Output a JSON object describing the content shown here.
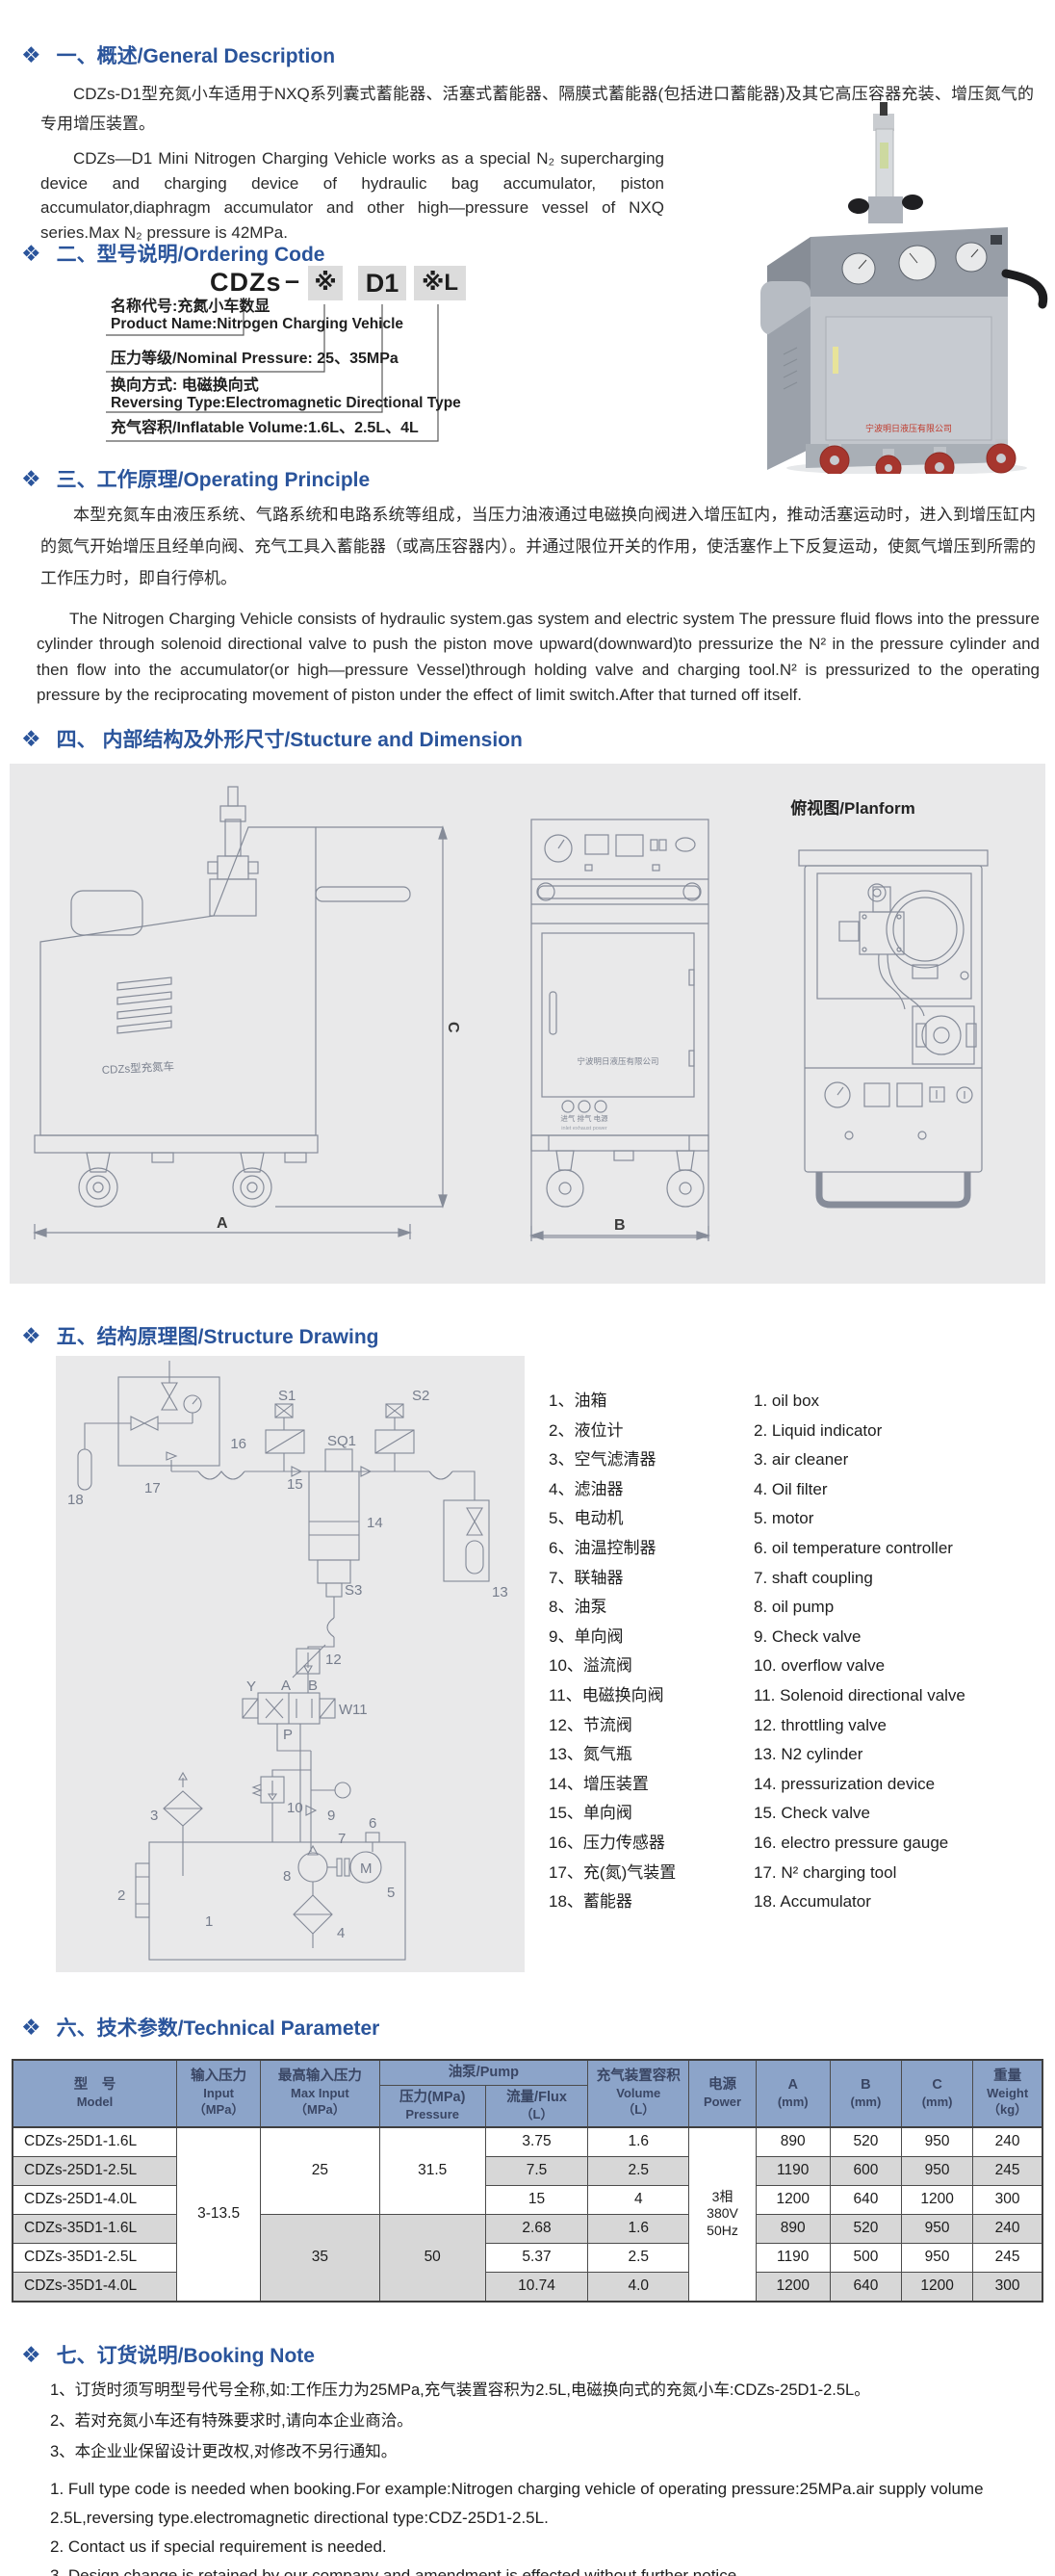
{
  "bullet": "❖",
  "s1": {
    "title": "一、概述/General Description",
    "para_cn": "CDZs-D1型充氮小车适用于NXQ系列囊式蓄能器、活塞式蓄能器、隔膜式蓄能器(包括进口蓄能器)及其它高压容器充装、增压氮气的专用增压装置。",
    "para_en": "CDZs—D1 Mini Nitrogen Charging Vehicle works as a special N₂ supercharging device and charging device of hydraulic bag accumulator, piston accumulator,diaphragm accumulator and other high—pressure vessel of NXQ series.Max N₂ pressure is 42MPa."
  },
  "photo": {
    "company_text": "宁波明日液压有限公司"
  },
  "s2": {
    "title": "二、型号说明/Ordering Code",
    "code": {
      "prefix": "CDZs",
      "dash": "–",
      "star": "※",
      "mid": "D1",
      "suffix": "※L"
    },
    "labels": {
      "l1_cn": "名称代号:充氮小车数显",
      "l1_en": "Product Name:Nitrogen Charging Vehicle",
      "l2": "压力等级/Nominal Pressure: 25、35MPa",
      "l3_cn": "换向方式: 电磁换向式",
      "l3_en": "Reversing Type:Electromagnetic Directional Type",
      "l4": "充气容积/Inflatable Volume:1.6L、2.5L、4L"
    }
  },
  "s3": {
    "title": "三、工作原理/Operating Principle",
    "para_cn": "本型充氮车由液压系统、气路系统和电路系统等组成，当压力油液通过电磁换向阀进入增压缸内，推动活塞运动时，进入到增压缸内的氮气开始增压且经单向阀、充气工具入蓄能器（或高压容器内）。并通过限位开关的作用，使活塞作上下反复运动，使氮气增压到所需的工作压力时，即自行停机。",
    "para_en": "The Nitrogen Charging Vehicle consists of hydraulic system.gas system and electric system The pressure fluid flows into the pressure cylinder through solenoid directional valve to push the piston move upward(downward)to pressurize the N² in the pressure cylinder and then flow into the accumulator(or high—pressure Vessel)through holding valve and charging tool.N² is pressurized to the operating pressure by the reciprocating movement of piston under the effect of limit switch.After that turned off itself."
  },
  "s4": {
    "title": "四、 内部结构及外形尺寸/Stucture and Dimension",
    "planform_label": "俯视图/Planform",
    "dim_a": "A",
    "dim_b": "B",
    "dim_c": "C",
    "side_label": "CDZs型充氮车",
    "front_company": "宁波明日液压有限公司",
    "port_labels": "进气  排气  电源",
    "port_labels_en": "inlet exhaust power"
  },
  "s5": {
    "title": "五、结构原理图/Structure Drawing",
    "parts_cn": [
      "1、油箱",
      "2、液位计",
      "3、空气滤清器",
      "4、滤油器",
      "5、电动机",
      "6、油温控制器",
      "7、联轴器",
      "8、油泵",
      "9、单向阀",
      "10、溢流阀",
      "11、电磁换向阀",
      "12、节流阀",
      "13、氮气瓶",
      "14、增压装置",
      "15、单向阀",
      "16、压力传感器",
      "17、充(氮)气装置",
      "18、蓄能器"
    ],
    "parts_en": [
      "1.  oil box",
      "2.  Liquid indicator",
      "3.  air cleaner",
      "4.  Oil filter",
      "5.  motor",
      "6.  oil temperature controller",
      "7.  shaft coupling",
      "8.  oil pump",
      "9.  Check valve",
      "10.  overflow valve",
      "11.  Solenoid directional valve",
      "12.  throttling valve",
      "13.  N2 cylinder",
      "14.  pressurization device",
      "15.  Check valve",
      "16.  electro pressure gauge",
      "17.  N² charging tool",
      "18.  Accumulator"
    ],
    "sch": {
      "s1": "S1",
      "s2": "S2",
      "sq1": "SQ1",
      "n16": "16",
      "n15": "15",
      "n17": "17",
      "n18": "18",
      "n14": "14",
      "s3": "S3",
      "n13": "13",
      "n12": "12",
      "n11": "11",
      "n10": "10",
      "n9": "9",
      "n8": "8",
      "n7": "7",
      "n6": "6",
      "n5": "5",
      "n4": "4",
      "n3": "3",
      "n2": "2",
      "n1": "1",
      "m": "M",
      "p": "P",
      "a": "A",
      "b": "B",
      "y": "Y",
      "w": "W"
    }
  },
  "s6": {
    "title": "六、技术参数/Technical Parameter",
    "header": {
      "model_cn": "型　号",
      "model_en": "Model",
      "input_cn": "输入压力",
      "input_en": "Input",
      "input_unit": "（MPa）",
      "max_cn": "最高输入压力",
      "max_en": "Max Input",
      "max_unit": "（MPa）",
      "pump": "油泵/Pump",
      "pressure_cn": "压力(MPa)",
      "pressure_en": "Pressure",
      "flux_cn": "流量/Flux",
      "flux_unit": "（L）",
      "volume_cn": "充气装置容积",
      "volume_en": "Volume",
      "volume_unit": "（L）",
      "power_cn": "电源",
      "power_en": "Power",
      "a": "A",
      "b": "B",
      "c": "C",
      "mm": "(mm)",
      "weight_cn": "重量",
      "weight_en": "Weight",
      "weight_unit": "（kg）"
    },
    "merged": {
      "input": "3-13.5",
      "max25": "25",
      "pressure25": "31.5",
      "max35": "35",
      "pressure35": "50",
      "power": "3相\n380V\n50Hz"
    },
    "rows": [
      {
        "model": "CDZs-25D1-1.6L",
        "flux": "3.75",
        "volume": "1.6",
        "a": "890",
        "b": "520",
        "c": "950",
        "weight": "240"
      },
      {
        "model": "CDZs-25D1-2.5L",
        "flux": "7.5",
        "volume": "2.5",
        "a": "1190",
        "b": "600",
        "c": "950",
        "weight": "245"
      },
      {
        "model": "CDZs-25D1-4.0L",
        "flux": "15",
        "volume": "4",
        "a": "1200",
        "b": "640",
        "c": "1200",
        "weight": "300"
      },
      {
        "model": "CDZs-35D1-1.6L",
        "flux": "2.68",
        "volume": "1.6",
        "a": "890",
        "b": "520",
        "c": "950",
        "weight": "240"
      },
      {
        "model": "CDZs-35D1-2.5L",
        "flux": "5.37",
        "volume": "2.5",
        "a": "1190",
        "b": "500",
        "c": "950",
        "weight": "245"
      },
      {
        "model": "CDZs-35D1-4.0L",
        "flux": "10.74",
        "volume": "4.0",
        "a": "1200",
        "b": "640",
        "c": "1200",
        "weight": "300"
      }
    ]
  },
  "s7": {
    "title": "七、订货说明/Booking Note",
    "cn": [
      "1、订货时须写明型号代号全称,如:工作压力为25MPa,充气装置容积为2.5L,电磁换向式的充氮小车:CDZs-25D1-2.5L。",
      "2、若对充氮小车还有特殊要求时,请向本企业商洽。",
      "3、本企业业保留设计更改权,对修改不另行通知。"
    ],
    "en": [
      "1. Full type code is needed when booking.For example:Nitrogen charging vehicle of operating pressure:25MPa.air supply volume 2.5L,reversing type.electromagnetic directional type:CDZ-25D1-2.5L.",
      "2. Contact us if special requirement is needed.",
      "3. Design change is retained by our company and amendment is effected without further notice."
    ]
  }
}
